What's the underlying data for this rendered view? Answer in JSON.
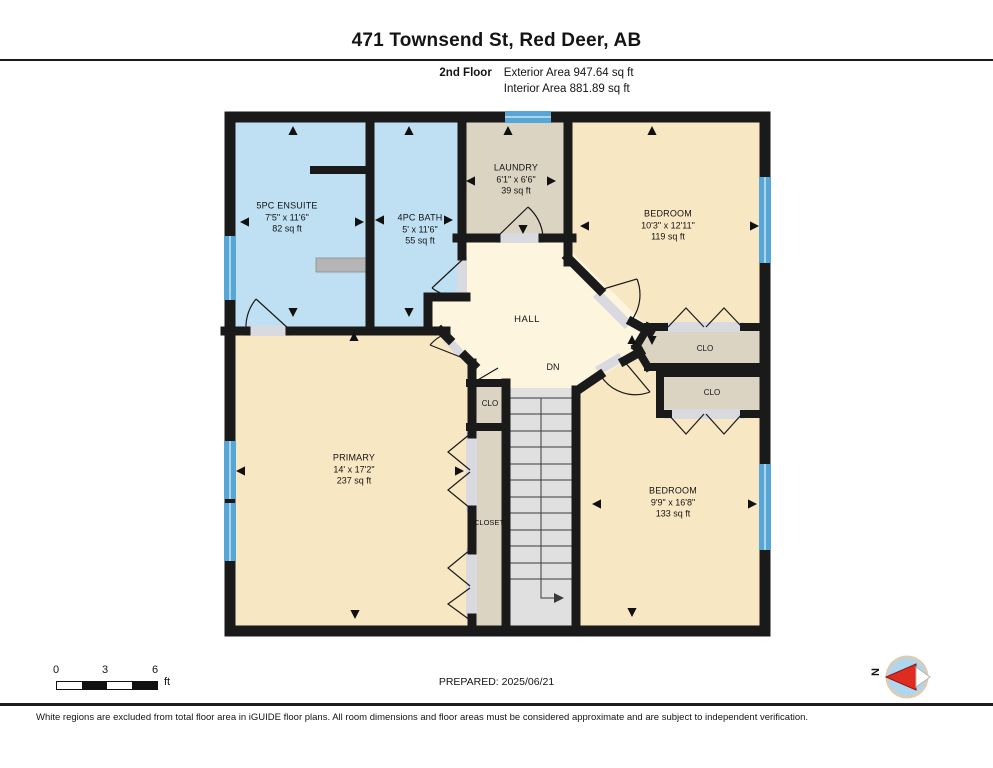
{
  "header": {
    "title": "471 Townsend St, Red Deer, AB",
    "floor_label": "2nd Floor",
    "exterior_area": "Exterior Area 947.64 sq ft",
    "interior_area": "Interior Area 881.89 sq ft"
  },
  "rooms": {
    "ensuite": {
      "name": "5PC ENSUITE",
      "dims": "7'5\" x 11'6\"",
      "area": "82 sq ft"
    },
    "bath": {
      "name": "4PC BATH",
      "dims": "5' x 11'6\"",
      "area": "55 sq ft"
    },
    "laundry": {
      "name": "LAUNDRY",
      "dims": "6'1\" x 6'6\"",
      "area": "39 sq ft"
    },
    "bedroom_upper": {
      "name": "BEDROOM",
      "dims": "10'3\" x 12'11\"",
      "area": "119 sq ft"
    },
    "bedroom_lower": {
      "name": "BEDROOM",
      "dims": "9'9\" x 16'8\"",
      "area": "133 sq ft"
    },
    "primary": {
      "name": "PRIMARY",
      "dims": "14' x 17'2\"",
      "area": "237 sq ft"
    },
    "hall": {
      "name": "HALL"
    },
    "closet": {
      "name": "CLOSET"
    },
    "clo_upper": {
      "name": "CLO"
    },
    "clo_lower": {
      "name": "CLO"
    },
    "clo_small": {
      "name": "CLO"
    },
    "stairs_label": "DN"
  },
  "footer": {
    "prepared": "PREPARED: 2025/06/21",
    "scale_ticks": [
      "0",
      "3",
      "6"
    ],
    "scale_unit": "ft",
    "compass_label": "N",
    "disclaimer": "White regions are excluded from total floor area in iGUIDE floor plans. All room dimensions and floor areas must be considered approximate and are subject to independent verification."
  },
  "icons": {
    "compass": "compass-icon",
    "dimension_arrow": "dimension-arrow-icon",
    "stairs_direction": "stairs-down-arrow-icon"
  },
  "colors": {
    "wall": "#1a1a1a",
    "wet_room_fill": "#bfe0f2",
    "bedroom_fill": "#f8e7c3",
    "hall_fill": "#fdf5dd",
    "closet_fill": "#dcd4c3",
    "stairs_fill": "#e0e0e0",
    "window_blue": "#58a6d6",
    "door_opening": "#d9d9e0",
    "compass_needle_red": "#e02b20"
  }
}
